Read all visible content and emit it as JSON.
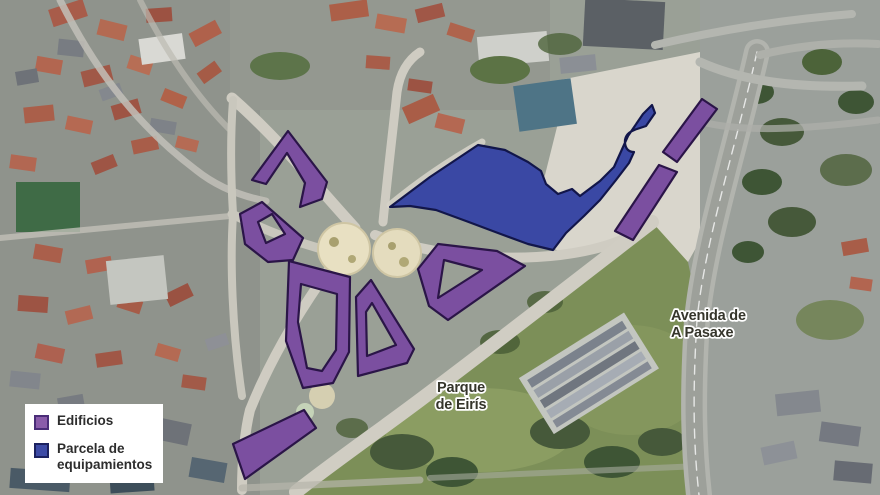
{
  "legend": {
    "items": [
      {
        "id": "edificios",
        "label": "Edificios",
        "color": "#8a5caa",
        "border": "#4a2d78"
      },
      {
        "id": "parcela",
        "label": "Parcela de equipamientos",
        "color": "#3d4ba6",
        "border": "#1c2260"
      }
    ]
  },
  "map_labels": [
    {
      "id": "parque-de-eiris",
      "lines": [
        "Parque",
        "de Eirís"
      ],
      "x": 461,
      "y": 392,
      "anchor": "middle"
    },
    {
      "id": "avenida-a-pasaxe",
      "lines": [
        "Avenida de",
        "A Pasaxe"
      ],
      "x": 671,
      "y": 320,
      "anchor": "start"
    }
  ],
  "overlays": {
    "buildings": {
      "legend_ref": "Edificios",
      "fill": "#7b4fa0",
      "stroke": "#2b1548",
      "paths": [
        "M252,180 L288,131 L327,182 L322,199 L300,207 L305,183 L287,153 L266,184 Z",
        "M240,214 L262,202 L303,238 L293,260 L268,262 L245,244 Z M258,222 L272,214 L285,234 L266,243 Z",
        "M289,261 L350,277 L349,352 L333,383 L303,388 L286,341 Z M301,284 L337,294 L336,350 L322,371 L307,368 L298,322 Z",
        "M371,280 L414,349 L407,363 L358,376 L356,297 Z M372,303 L396,345 L367,356 L366,312 Z",
        "M438,244 L497,251 L525,266 L448,320 L429,306 L418,269 Z M444,260 L482,270 L438,298 Z",
        "M663,152 L702,99 L717,109 L677,162 Z",
        "M659,165 L677,172 L633,240 L615,231 Z",
        "M233,444 L304,410 L316,428 L245,479 Z"
      ]
    },
    "parcel": {
      "legend_ref": "Parcela de equipamientos",
      "fill": "#3a48a4",
      "stroke": "#12164a",
      "paths": [
        "M390,207 L430,177 L478,145 L505,150 L528,162 L541,171 L546,184 L558,194 L572,189 L580,196 L600,181 L614,167 L628,136 L643,114 L652,105 L655,113 L646,126 L637,129 Q624,133 625,143 Q626,152 634,152 L629,163 L616,180 L600,200 L584,216 L566,233 L553,250 L528,244 L498,233 L466,221 L436,210 L410,206 Z"
      ]
    }
  }
}
